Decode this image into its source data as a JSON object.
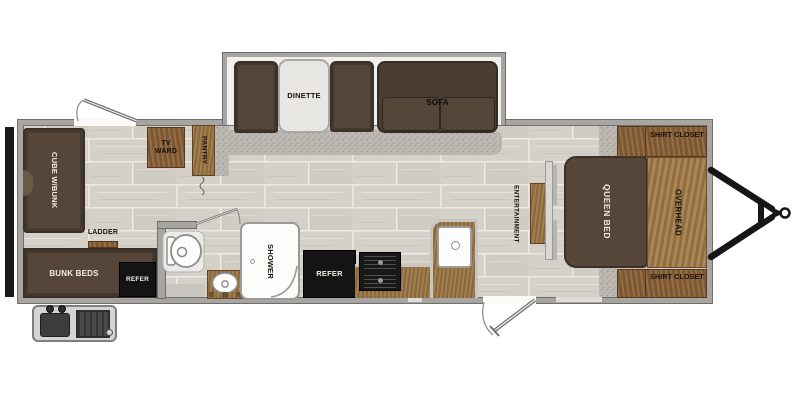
{
  "diagram_type": "travel-trailer floor plan",
  "labels": {
    "dinette": "DINETTE",
    "sofa": "SOFA",
    "shirt_closet_top": "SHIRT CLOSET",
    "shirt_closet_bottom": "SHIRT CLOSET",
    "overhead": "OVERHEAD",
    "queen_bed": "QUEEN BED",
    "entertainment": "ENTERTAINMENT",
    "refer_kitchen": "REFER",
    "refer_bunk": "REFER",
    "bunk_beds": "BUNK BEDS",
    "cube_bunk": "CUBE W/BUNK",
    "ladder": "LADDER",
    "tv_ward": "TV WARD",
    "pantry": "PANTRY",
    "shower": "SHOWER"
  },
  "colors": {
    "wood": "#96713f",
    "wood_dark": "#8a6238",
    "wood_light": "#9d7641",
    "upholstery": "#564639",
    "upholstery_dark": "#4a3e33",
    "appliance": "#141414",
    "wall": "#a6a5a2",
    "wall_edge": "#6f6e6b",
    "fixture": "#fcfcfa",
    "counter_edge": "#c8c6c2",
    "floor_tile": "#d6d1c8",
    "floor_grout": "#eceae5",
    "speckle_floor": "#bdb9b2",
    "hitch": "#161616"
  }
}
